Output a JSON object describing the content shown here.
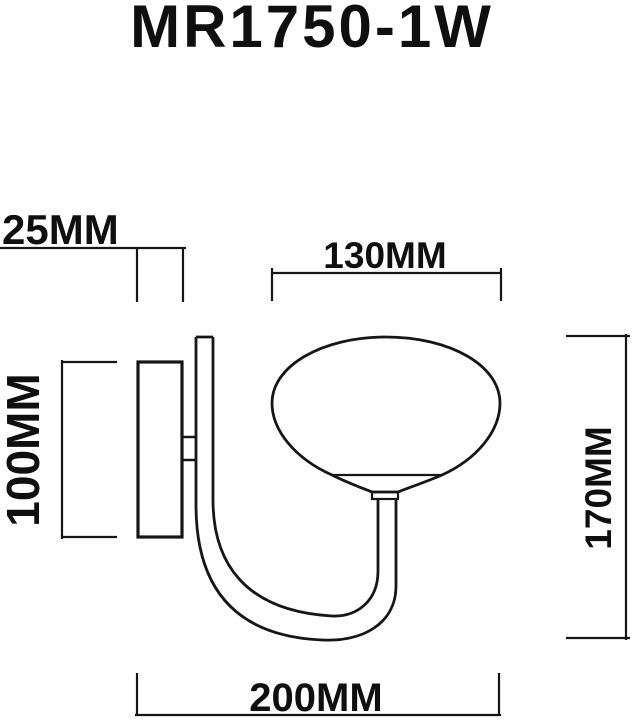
{
  "page": {
    "background_color": "#ffffff",
    "line_color": "#161616",
    "text_color": "#0f0f0f"
  },
  "title": "MR1750-1W",
  "dimensions": {
    "mount_depth": "25MM",
    "shade_width": "130MM",
    "backplate_height": "100MM",
    "fixture_height": "170MM",
    "total_projection": "200MM"
  }
}
